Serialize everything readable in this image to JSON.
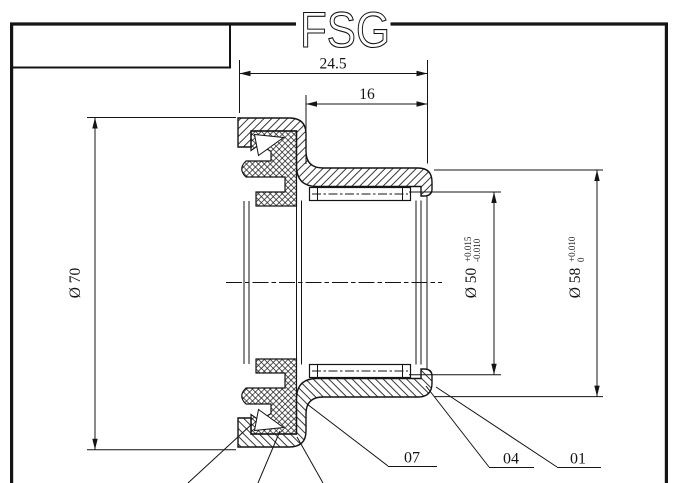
{
  "colors": {
    "ink": "#141414",
    "background": "#ffffff"
  },
  "title": {
    "text": "FSG"
  },
  "dimensions": {
    "overall_width": {
      "label": "24.5"
    },
    "seat_width": {
      "label": "16"
    },
    "outer_diameter": {
      "label": "Ø 70"
    },
    "bore_diameter": {
      "label": "Ø 50",
      "tol_upper": "+0.015",
      "tol_lower": "-0.010"
    },
    "sleeve_diameter": {
      "label": "Ø 58",
      "tol_upper": "+0.010",
      "tol_lower": "0"
    }
  },
  "part_labels": {
    "item_07": "07",
    "item_04": "04",
    "item_01": "01"
  }
}
